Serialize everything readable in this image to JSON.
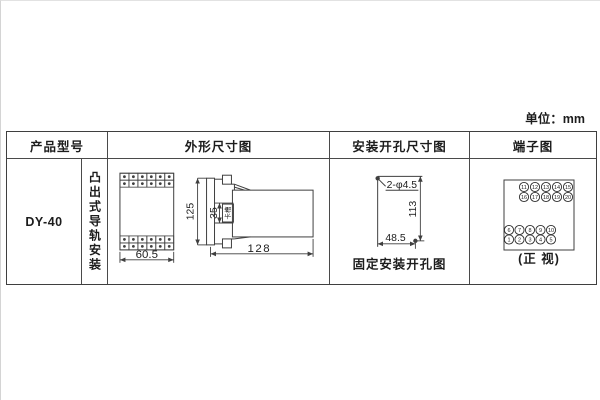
{
  "unit_label": "单位：mm",
  "table": {
    "headers": {
      "product_model": "产品型号",
      "outline": "外形尺寸图",
      "mounting": "安装开孔尺寸图",
      "terminal": "端子图"
    },
    "product": {
      "model": "DY-40",
      "mounting_type": "凸出式导轨安装"
    }
  },
  "outline_drawing": {
    "front_width": "60.5",
    "side_height": "125",
    "slot_height": "35",
    "slot_label": "卡槽",
    "side_depth": "128"
  },
  "mounting_drawing": {
    "holes_label": "2-φ4.5",
    "vertical_distance": "113",
    "horizontal_distance": "48.5",
    "caption": "固定安装开孔图"
  },
  "terminal_diagram": {
    "top_rows": [
      [
        "11",
        "12",
        "13",
        "14",
        "15"
      ],
      [
        "16",
        "17",
        "18",
        "19",
        "20"
      ]
    ],
    "bottom_rows": [
      [
        "6",
        "7",
        "8",
        "9",
        "10"
      ],
      [
        "1",
        "2",
        "3",
        "4",
        "5"
      ]
    ],
    "caption": "(正 视)"
  }
}
